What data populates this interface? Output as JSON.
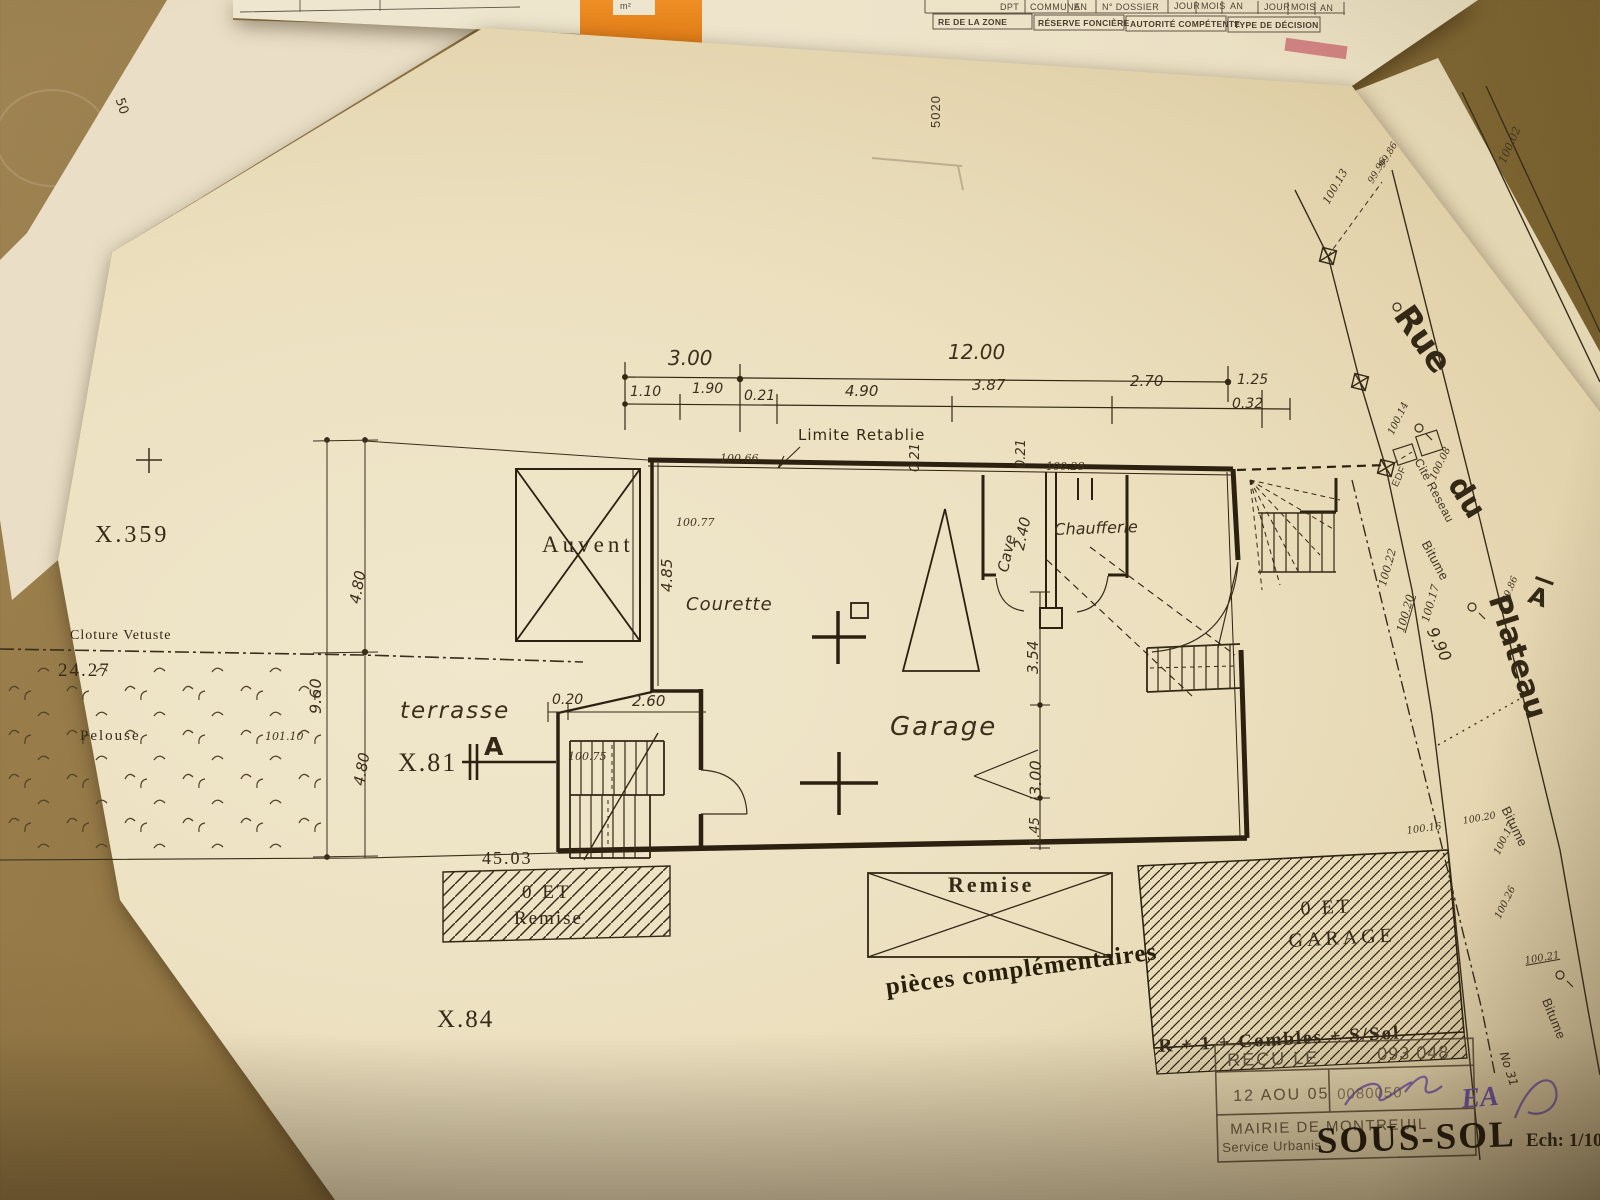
{
  "form_sheet": {
    "corner_note": "50",
    "unit": "m²",
    "sheet_no": "5020",
    "row1": {
      "dpt": "DPT",
      "commune": "COMMUNE",
      "an1": "AN",
      "dossier": "N° DOSSIER",
      "jour1": "JOUR",
      "mois1": "MOIS",
      "an2": "AN",
      "jour2": "JOUR",
      "mois2": "MOIS",
      "an3": "AN"
    },
    "row2": {
      "zone": "RE DE LA ZONE",
      "reserve": "RÉSERVE FONCIÈRE",
      "autorite": "AUTORITÉ COMPÉTENTE",
      "decision": "TYPE DE DÉCISION"
    }
  },
  "plan": {
    "parcels": {
      "left": "X.359",
      "center": "X.81",
      "bottom": "X.84"
    },
    "site": {
      "fence": "Cloture Vetuste",
      "fence_length": "24.27",
      "lawn": "Pelouse",
      "lawn_level": "101.10",
      "terrace": "terrasse",
      "plot_width": "45.03",
      "limit": "Limite Retablie",
      "section_mark": "A"
    },
    "rooms": {
      "canopy": "Auvent",
      "courtyard": "Courette",
      "garage": "Garage",
      "cellar": "Cave",
      "boiler": "Chaufferie",
      "shed": "Remise"
    },
    "annexes": {
      "shed_line1": "0 ET",
      "shed_line2": "Remise",
      "garage_line1": "0 ET",
      "garage_line2": "GARAGE",
      "storeys": "R + 1 + Combles + S/Sol"
    },
    "dims": {
      "top_total_a": "3.00",
      "top_total_b": "12.00",
      "t110": "1.10",
      "t190": "1.90",
      "t021": "0.21",
      "t490": "4.90",
      "t387": "3.87",
      "t270": "2.70",
      "t125": "1.25",
      "t032": "0.32",
      "left_total": "9.60",
      "left_a": "4.80",
      "left_b": "4.80",
      "court_h": "4.85",
      "court_a": "0.20",
      "court_b": "2.60",
      "v021a": "0.21",
      "v021b": "0.21",
      "cellar_w": "2.40",
      "g354": "3.54",
      "g300": "3.00",
      "g145": "1.45"
    },
    "levels": {
      "l1": "100.66",
      "l2": "100.77",
      "l3": "100.28",
      "l4": "100.75",
      "l5": "100.02",
      "l6": "100.13",
      "l7": "99.86",
      "l8": "99.96",
      "l9": "100.14",
      "l10": "100.08",
      "edf": "EDF",
      "l11": "100.22",
      "l12": "100.20",
      "l13": "100.17",
      "l14": "99.86",
      "l15": "100.16",
      "l16": "100.20",
      "l17": "100.17",
      "l18": "100.26",
      "l19": "100.21"
    },
    "street": {
      "word1": "Rue",
      "word2": "du",
      "word3": "Plateau",
      "section_mark": "A",
      "network": "Cite Reseau",
      "surface1": "Bitume",
      "surface2": "Bitume",
      "surface3": "Bitume",
      "width": "9.90",
      "note": "No 31"
    }
  },
  "stamps": {
    "complement": "pièces complémentaires",
    "received": "REÇU LE",
    "received_no": "093 048",
    "date": "12 AOU 05",
    "reg_no": "0080050",
    "authority": "MAIRIE DE MONTREUIL",
    "service": "Service Urbanis",
    "drawing_title": "SOUS-SOL",
    "scale": "Ech: 1/100",
    "initials": "EA"
  },
  "colors": {
    "paper": "#efe6cc",
    "desk": "#7a6138",
    "ink": "#2e2416",
    "tab_orange": "#e8821c",
    "stamp_purple": "#6a4fae"
  }
}
